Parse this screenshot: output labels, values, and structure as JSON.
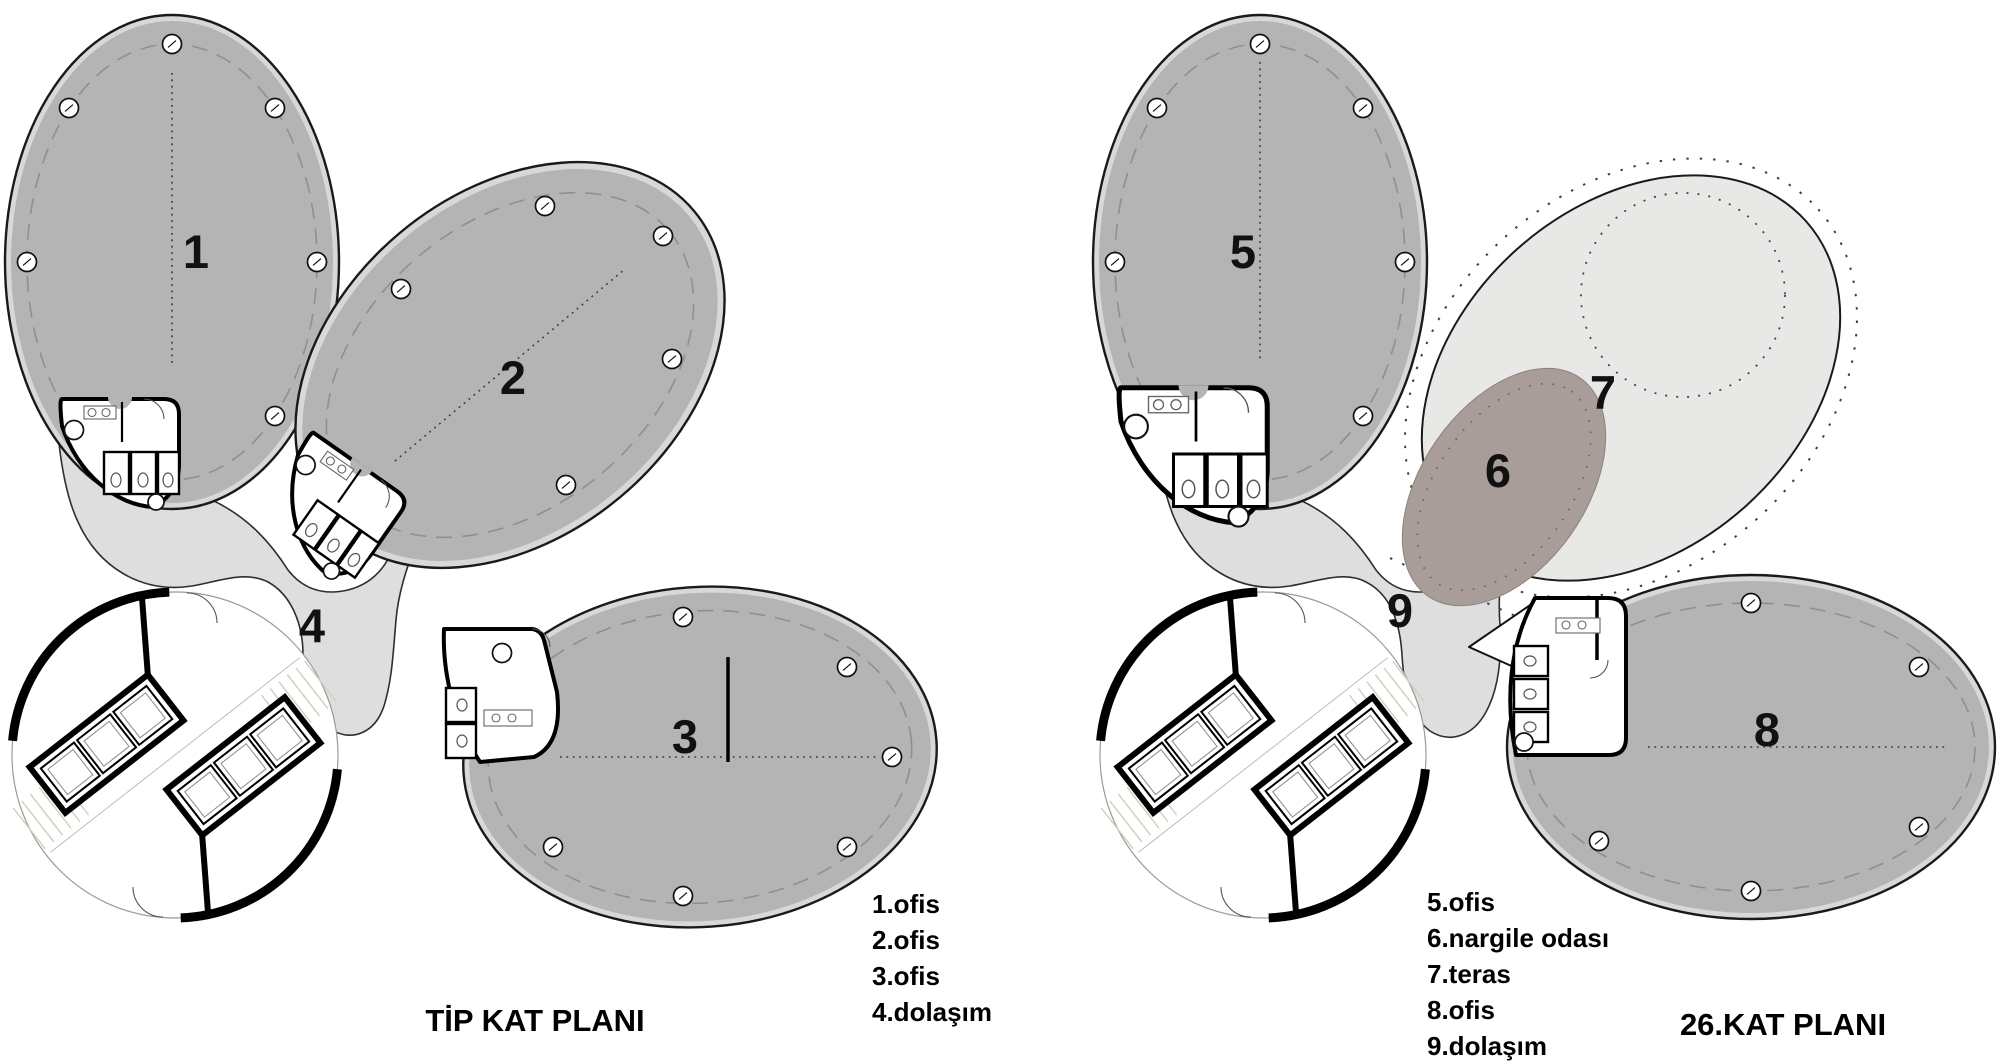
{
  "sheet": {
    "description": "Two architectural floor plans of a four-lobed tower: typical floor plan and 26th floor plan",
    "colors": {
      "office_fill": "#b4b4b4",
      "circulation_fill": "#dedede",
      "terrace_fill": "#e8e8e6",
      "hookah_room_fill": "#a89d99",
      "outline": "#1a1a1a",
      "background": "#ffffff"
    },
    "plans": [
      {
        "title": "TİP KAT PLANI",
        "zones": [
          {
            "number": "1",
            "name": "ofis"
          },
          {
            "number": "2",
            "name": "ofis"
          },
          {
            "number": "3",
            "name": "ofis"
          },
          {
            "number": "4",
            "name": "dolaşım"
          }
        ],
        "legend": [
          "1.ofis",
          "2.ofis",
          "3.ofis",
          "4.dolaşım"
        ]
      },
      {
        "title": "26.KAT PLANI",
        "zones": [
          {
            "number": "5",
            "name": "ofis"
          },
          {
            "number": "6",
            "name": "nargile odası"
          },
          {
            "number": "7",
            "name": "teras"
          },
          {
            "number": "8",
            "name": "ofis"
          },
          {
            "number": "9",
            "name": "dolaşım"
          }
        ],
        "legend": [
          "5.ofis",
          "6.nargile odası",
          "7.teras",
          "8.ofis",
          "9.dolaşım"
        ]
      }
    ]
  }
}
